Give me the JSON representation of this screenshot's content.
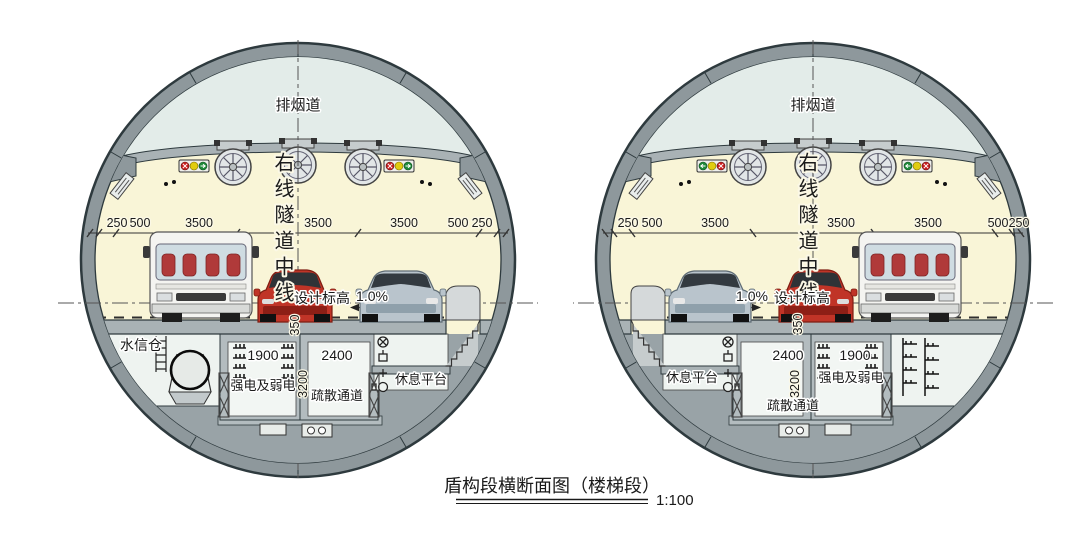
{
  "title": {
    "text": "盾构段横断面图（楼梯段）",
    "scale": "1:100"
  },
  "colors": {
    "ring": "#8e989c",
    "ring_outline": "#2e3a3e",
    "smoke_duct": "#e3ece9",
    "cavity": "#f9f5d7",
    "slab": "#a9b2b5",
    "interior": "#eef3f0",
    "invert": "#99a3a7",
    "red_car": "#c03427",
    "silver_car": "#b9c4cc",
    "bus": "#f4f4f1",
    "signal_red": "#cc2020",
    "signal_yellow": "#e0cc10",
    "signal_green": "#1f8a3a"
  },
  "tunnels": [
    {
      "side": "left",
      "duct_label": "排烟道",
      "centerline_label": "右线隧道中线",
      "dims": [
        "250",
        "500",
        "3500",
        "3500",
        "3500",
        "500",
        "250"
      ],
      "design_level": "设计标高",
      "slope": "1.0%",
      "height_350": "350",
      "water_bay": "水信仓",
      "power_width": "1900",
      "power_label": "强电及弱电",
      "evac_width": "2400",
      "evac_height": "3200",
      "evac_label": "疏散通道",
      "platform_label": "休息平台"
    },
    {
      "side": "right",
      "duct_label": "排烟道",
      "centerline_label": "右线隧道中线",
      "dims": [
        "250",
        "500",
        "3500",
        "3500",
        "3500",
        "500",
        "250"
      ],
      "design_level": "设计标高",
      "slope": "1.0%",
      "height_350": "350",
      "power_width": "1900",
      "power_label": "强电及弱电",
      "evac_width": "2400",
      "evac_height": "3200",
      "evac_label": "疏散通道",
      "platform_label": "休息平台"
    }
  ]
}
